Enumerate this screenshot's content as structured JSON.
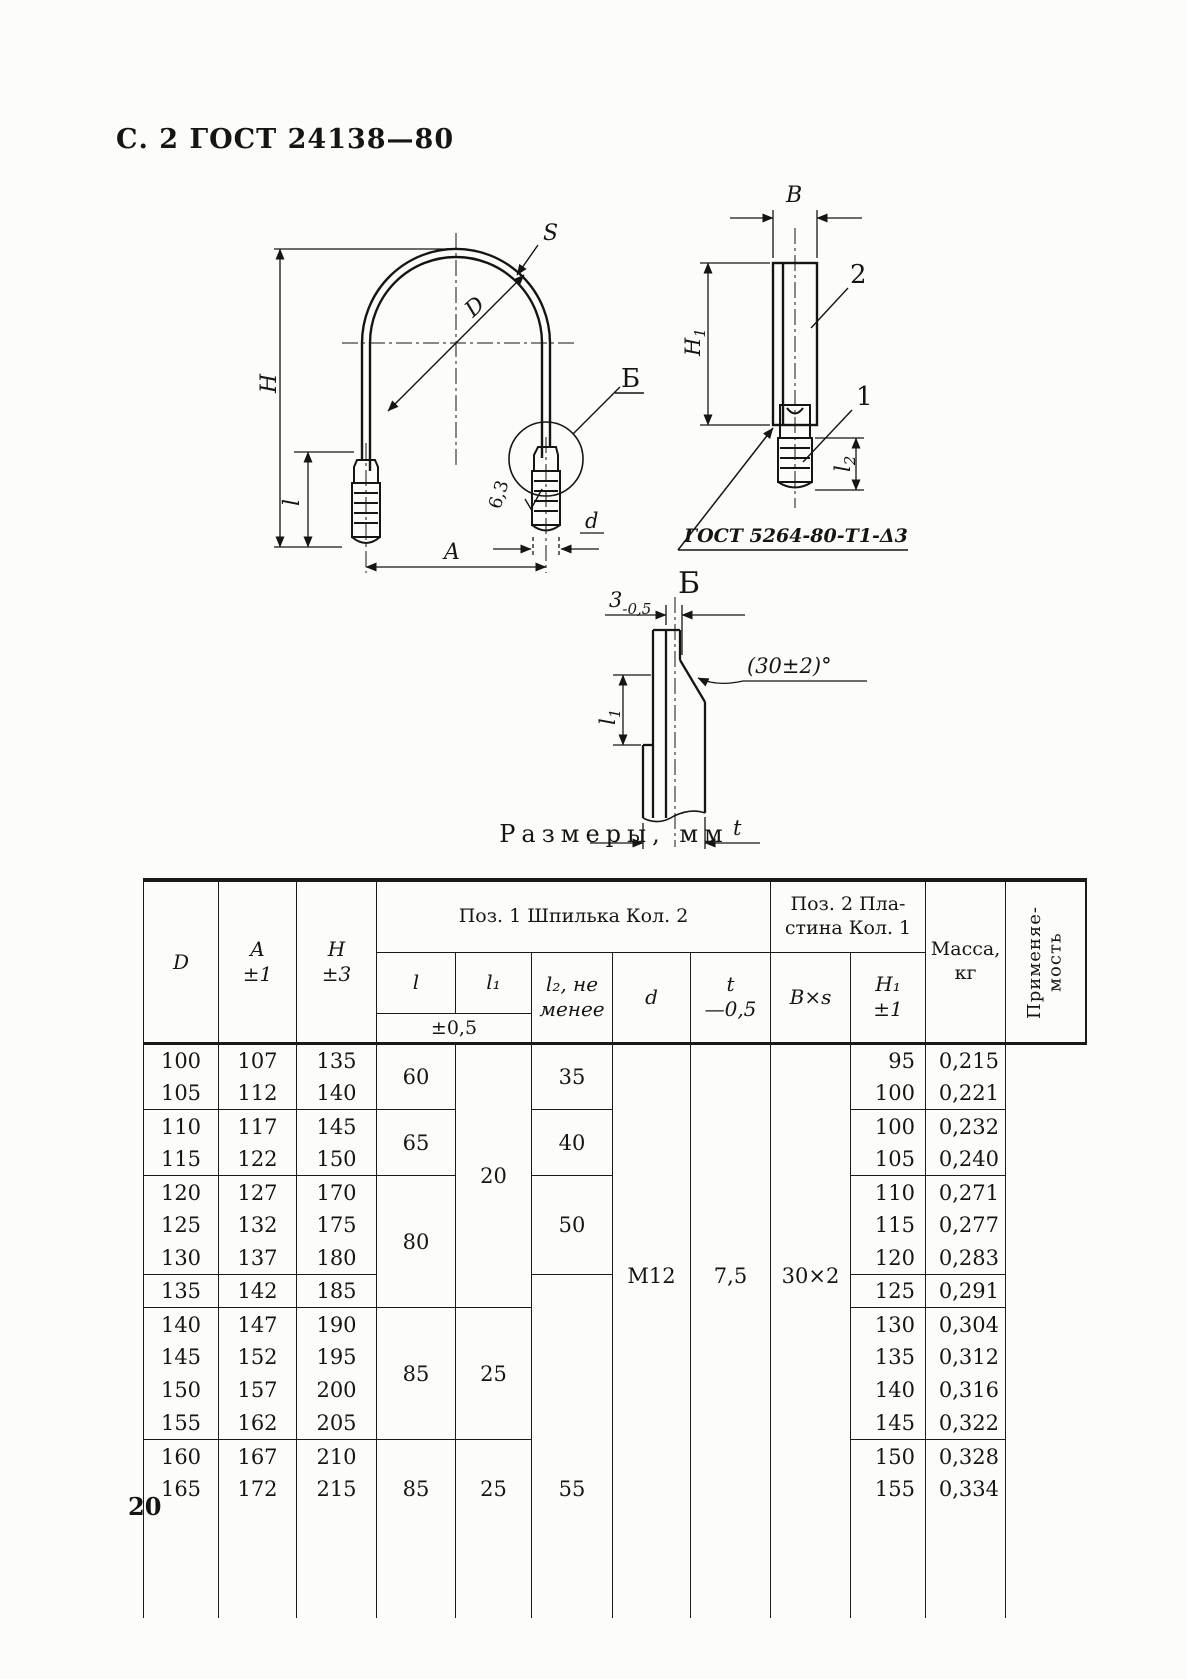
{
  "page": {
    "header": "С. 2 ГОСТ 24138—80",
    "number": "20"
  },
  "figures": {
    "clamp": {
      "s": "S",
      "diameter": "D",
      "height": "H",
      "length": "l",
      "width": "A",
      "stud_diameter": "d",
      "roughness": "6,3",
      "detail_mark": "Б"
    },
    "plate": {
      "width": "B",
      "height_main": "H",
      "height_sub": "1",
      "pos_plate": "2",
      "pos_stud": "1",
      "stud_len_main": "l",
      "stud_len_sub": "2",
      "weld": "ГОСТ 5264-80-Т1-Δ3"
    },
    "detail": {
      "title": "Б",
      "gap": "3",
      "gap_tol": "-0,5",
      "angle": "(30±2)°",
      "l1_main": "l",
      "l1_sub": "1",
      "thickness": "t"
    }
  },
  "table": {
    "title": "Размеры, мм",
    "head": {
      "d": "D",
      "a": "A\n±1",
      "h": "H\n±3",
      "group1": "Поз. 1 Шпилька Кол. 2",
      "group2": "Поз. 2 Пла-\nстина Кол. 1",
      "l": "l",
      "l1": "l₁",
      "tol": "±0,5",
      "l2": "l₂, не\nменее",
      "thread": "d",
      "t": "t\n—0,5",
      "bxs": "B×s",
      "h1": "H₁\n±1",
      "mass": "Масса,\nкг",
      "usage": "Применяе-\nмость"
    },
    "body": [
      [
        "100",
        "107",
        "135",
        {
          "v": "60",
          "rs": 2,
          "b": 1
        },
        {
          "v": "20",
          "rs": 8,
          "b": 1
        },
        {
          "v": "35",
          "rs": 2,
          "b": 1
        },
        {
          "v": "М12",
          "rs": 14
        },
        {
          "v": "7,5",
          "rs": 14
        },
        {
          "v": "30×2",
          "rs": 14
        },
        "95",
        "0,215",
        {
          "v": "",
          "rs": 14
        }
      ],
      [
        {
          "v": "105",
          "b": 1
        },
        {
          "v": "112",
          "b": 1
        },
        {
          "v": "140",
          "b": 1
        },
        null,
        null,
        null,
        null,
        null,
        null,
        {
          "v": "100",
          "b": 1
        },
        {
          "v": "0,221",
          "b": 1
        },
        null
      ],
      [
        "110",
        "117",
        "145",
        {
          "v": "65",
          "rs": 2,
          "b": 1
        },
        null,
        {
          "v": "40",
          "rs": 2,
          "b": 1
        },
        null,
        null,
        null,
        "100",
        "0,232",
        null
      ],
      [
        {
          "v": "115",
          "b": 1
        },
        {
          "v": "122",
          "b": 1
        },
        {
          "v": "150",
          "b": 1
        },
        null,
        null,
        null,
        null,
        null,
        null,
        {
          "v": "105",
          "b": 1
        },
        {
          "v": "0,240",
          "b": 1
        },
        null
      ],
      [
        "120",
        "127",
        "170",
        {
          "v": "80",
          "rs": 4,
          "b": 1
        },
        null,
        {
          "v": "50",
          "rs": 3,
          "b": 1
        },
        null,
        null,
        null,
        "110",
        "0,271",
        null
      ],
      [
        "125",
        "132",
        "175",
        null,
        null,
        null,
        null,
        null,
        null,
        "115",
        "0,277",
        null
      ],
      [
        {
          "v": "130",
          "b": 1
        },
        {
          "v": "137",
          "b": 1
        },
        {
          "v": "180",
          "b": 1
        },
        null,
        null,
        null,
        null,
        null,
        null,
        {
          "v": "120",
          "b": 1
        },
        {
          "v": "0,283",
          "b": 1
        },
        null
      ],
      [
        {
          "v": "135",
          "b": 1
        },
        {
          "v": "142",
          "b": 1
        },
        {
          "v": "185",
          "b": 1
        },
        null,
        null,
        {
          "v": "55",
          "rs": 7,
          "va": 1
        },
        null,
        null,
        null,
        {
          "v": "125",
          "b": 1
        },
        {
          "v": "0,291",
          "b": 1
        },
        null
      ],
      [
        "140",
        "147",
        "190",
        {
          "v": "85",
          "rs": 4,
          "b": 1
        },
        {
          "v": "25",
          "rs": 4,
          "b": 1
        },
        null,
        null,
        null,
        null,
        "130",
        "0,304",
        null
      ],
      [
        "145",
        "152",
        "195",
        null,
        null,
        null,
        null,
        null,
        null,
        "135",
        "0,312",
        null
      ],
      [
        "150",
        "157",
        "200",
        null,
        null,
        null,
        null,
        null,
        null,
        "140",
        "0,316",
        null
      ],
      [
        {
          "v": "155",
          "b": 1
        },
        {
          "v": "162",
          "b": 1
        },
        {
          "v": "205",
          "b": 1
        },
        null,
        null,
        null,
        null,
        null,
        null,
        {
          "v": "145",
          "b": 1
        },
        {
          "v": "0,322",
          "b": 1
        },
        null
      ],
      [
        "160",
        "167",
        "210",
        {
          "v": "85",
          "rs": 2,
          "va": 1
        },
        {
          "v": "25",
          "rs": 2,
          "va": 1
        },
        null,
        null,
        null,
        null,
        "150",
        "0,328",
        null
      ],
      [
        "165",
        "172",
        "215",
        null,
        null,
        null,
        null,
        null,
        null,
        "155",
        "0,334",
        null
      ]
    ]
  }
}
